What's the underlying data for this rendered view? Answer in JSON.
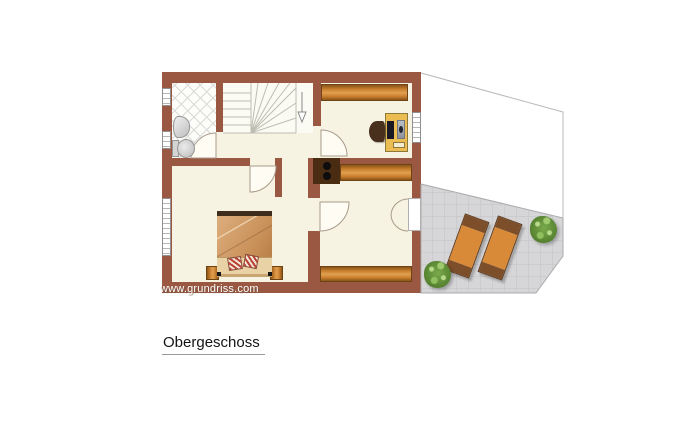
{
  "title": {
    "text": "Obergeschoss"
  },
  "watermark": {
    "text": "www.grundriss.com"
  },
  "colors": {
    "wall": "#9a5842",
    "floor": "#f7f3e2",
    "wood": "#c97f2e",
    "terrace": "#d6d6d8",
    "desk": "#eabc52",
    "lounger": "#d88a38",
    "plant": "#55812f",
    "bed_blanket": "#c99059"
  }
}
